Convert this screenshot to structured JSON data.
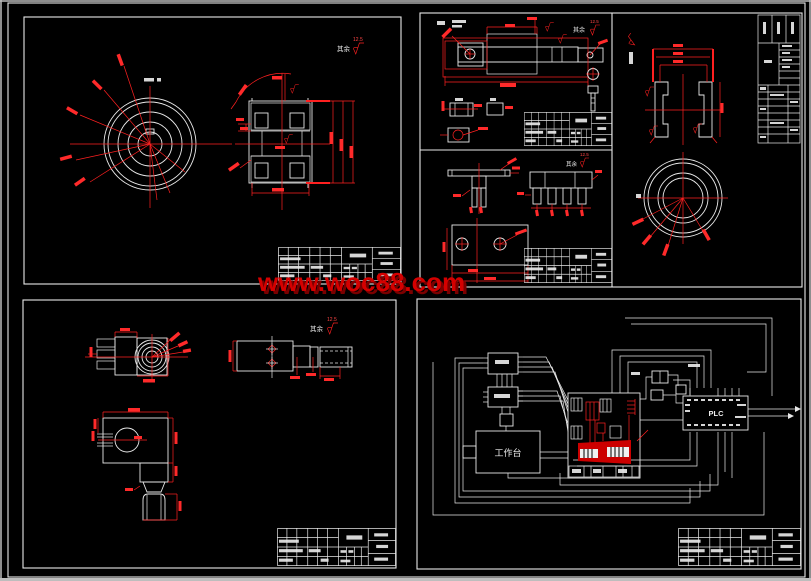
{
  "watermark": {
    "text": "www.woc88.com"
  },
  "labels": {
    "plc": "PLC",
    "workbench": "工作台",
    "roughness_prefix": "其余",
    "roughness_value": "12.5"
  },
  "colors": {
    "background": "#000000",
    "drawing_line": "#e8e8e8",
    "dimension_red": "#ff2020",
    "hatch_blue": "#2222dd",
    "watermark_red": "#d40000",
    "watermark_shadow": "#7a0000",
    "window_edge_gray": "#bdbdbd"
  }
}
